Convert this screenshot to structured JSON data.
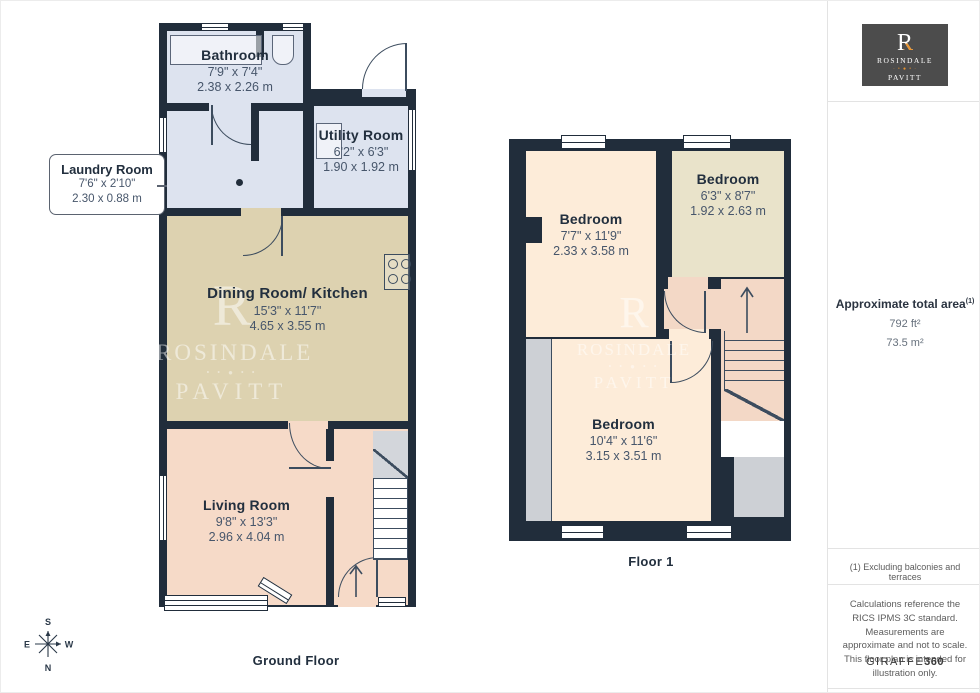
{
  "gf": {
    "floor_label": "Ground Floor",
    "bathroom": {
      "name": "Bathroom",
      "ft": "7'9\" x 7'4\"",
      "m": "2.38 x 2.26 m"
    },
    "laundry": {
      "name": "Laundry Room",
      "ft": "7'6\" x 2'10\"",
      "m": "2.30 x 0.88 m"
    },
    "utility": {
      "name": "Utility Room",
      "ft": "6'2\" x 6'3\"",
      "m": "1.90 x 1.92 m"
    },
    "dining_kitchen": {
      "name": "Dining Room/ Kitchen",
      "ft": "15'3\" x 11'7\"",
      "m": "4.65 x 3.55 m"
    },
    "living": {
      "name": "Living Room",
      "ft": "9'8\" x 13'3\"",
      "m": "2.96 x 4.04 m"
    }
  },
  "f1": {
    "floor_label": "Floor 1",
    "bedroom_left": {
      "name": "Bedroom",
      "ft": "7'7\" x 11'9\"",
      "m": "2.33 x 3.58 m"
    },
    "bedroom_small": {
      "name": "Bedroom",
      "ft": "6'3\" x 8'7\"",
      "m": "1.92 x 2.63 m"
    },
    "bedroom_main": {
      "name": "Bedroom",
      "ft": "10'4\" x 11'6\"",
      "m": "3.15 x 3.51 m"
    }
  },
  "watermark": {
    "monogram": "R",
    "line1": "ROSINDALE",
    "dots": "• • ● • •",
    "line2": "PAVITT"
  },
  "logo": {
    "monogram": "R",
    "line1": "ROSINDALE",
    "dots": "· • ● • ·",
    "line2": "PAVITT"
  },
  "sidebar": {
    "area_title": "Approximate total area",
    "area_note_ref": "(1)",
    "area_imperial": "792 ft²",
    "area_metric": "73.5 m²",
    "footnote": "(1) Excluding balconies and terraces",
    "disclaimer": "Calculations reference the RICS IPMS 3C standard. Measurements are approximate and not to scale. This floor plan is intended for illustration only.",
    "brand": "GIRAFFE",
    "brand_suffix": "360"
  },
  "compass": {
    "north": "N",
    "south": "S",
    "east": "E",
    "west": "W"
  },
  "colors": {
    "wall": "#212d3b",
    "wet": "#dde3ef",
    "tan": "#ddd2b0",
    "living": "#f6dac8",
    "cream": "#fdecd9",
    "olive": "#e9e3ca",
    "landing": "#f3d8c6",
    "gray1": "#d3d6db",
    "gray2": "#cdd0d5",
    "ink": "#222f3e",
    "dim": "#47566b",
    "orange": "#e8932f",
    "line": "#3c4c5e"
  }
}
